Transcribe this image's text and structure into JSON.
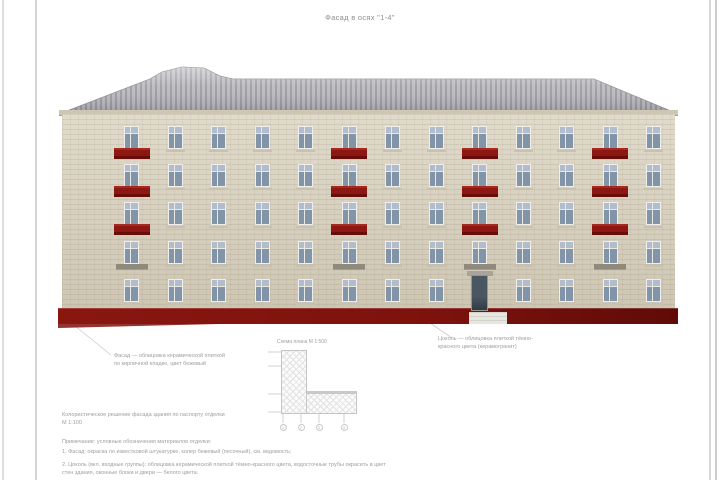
{
  "sheet": {
    "title": "Фасад в осях \"1-4\""
  },
  "facade": {
    "floors": 5,
    "window_columns": 13,
    "balcony_columns_1based": [
      1,
      6,
      9,
      12
    ],
    "entrance_column_1based": 9,
    "colors": {
      "wall": "#d6ceba",
      "cornice": "#cdc6b3",
      "roof_light": "#bababf",
      "roof_dark": "#9a9aa0",
      "window_frame": "#efeeea",
      "window_mullion": "#e9e8e3",
      "window_glass": "#8fa1b6",
      "window_sill": "#c8c1ae",
      "balcony": "#8d1712",
      "balcony_light": "#a5291f",
      "balcony_dark": "#690d09",
      "floor2_canopy": "#8f8a7c",
      "plinth": "#7d120d",
      "plinth_dark": "#600b08",
      "door": "#4b5663",
      "door_dark": "#323b45",
      "entry_step": "#e7e5df",
      "leader_line": "#cbcbcb",
      "text": "#9e9e9e",
      "plan_outline": "#c5c5c5",
      "plan_hatch": "#e2e2e2"
    }
  },
  "annotations": {
    "left_note": {
      "line1": "Фасад — облицовка керамической плиткой",
      "line2": "по кирпичной кладке, цвет бежевый"
    },
    "right_note": {
      "line1": "Цоколь — облицовка плиткой тёмно-",
      "line2": "красного цвета (керамогранит)"
    },
    "plan_label": "Схема плана М 1:500",
    "notes": [
      "Колористическое решение фасада здания по паспорту отделки",
      "М 1:100",
      "Примечание: условные обозначения материалов отделки:",
      "1. Фасад: окраска по известковой штукатурке, колер бежевый (песочный), см. ведомость;",
      "2. Цоколь (вкл. входные группы): облицовка керамической плиткой тёмно-красного цвета, водосточные трубы окрасить в цвет",
      "стен здания, оконные блоки и двери — белого цвета."
    ]
  },
  "key_plan": {
    "axis_bubbles": [
      "1",
      "2",
      "3",
      "4"
    ]
  }
}
